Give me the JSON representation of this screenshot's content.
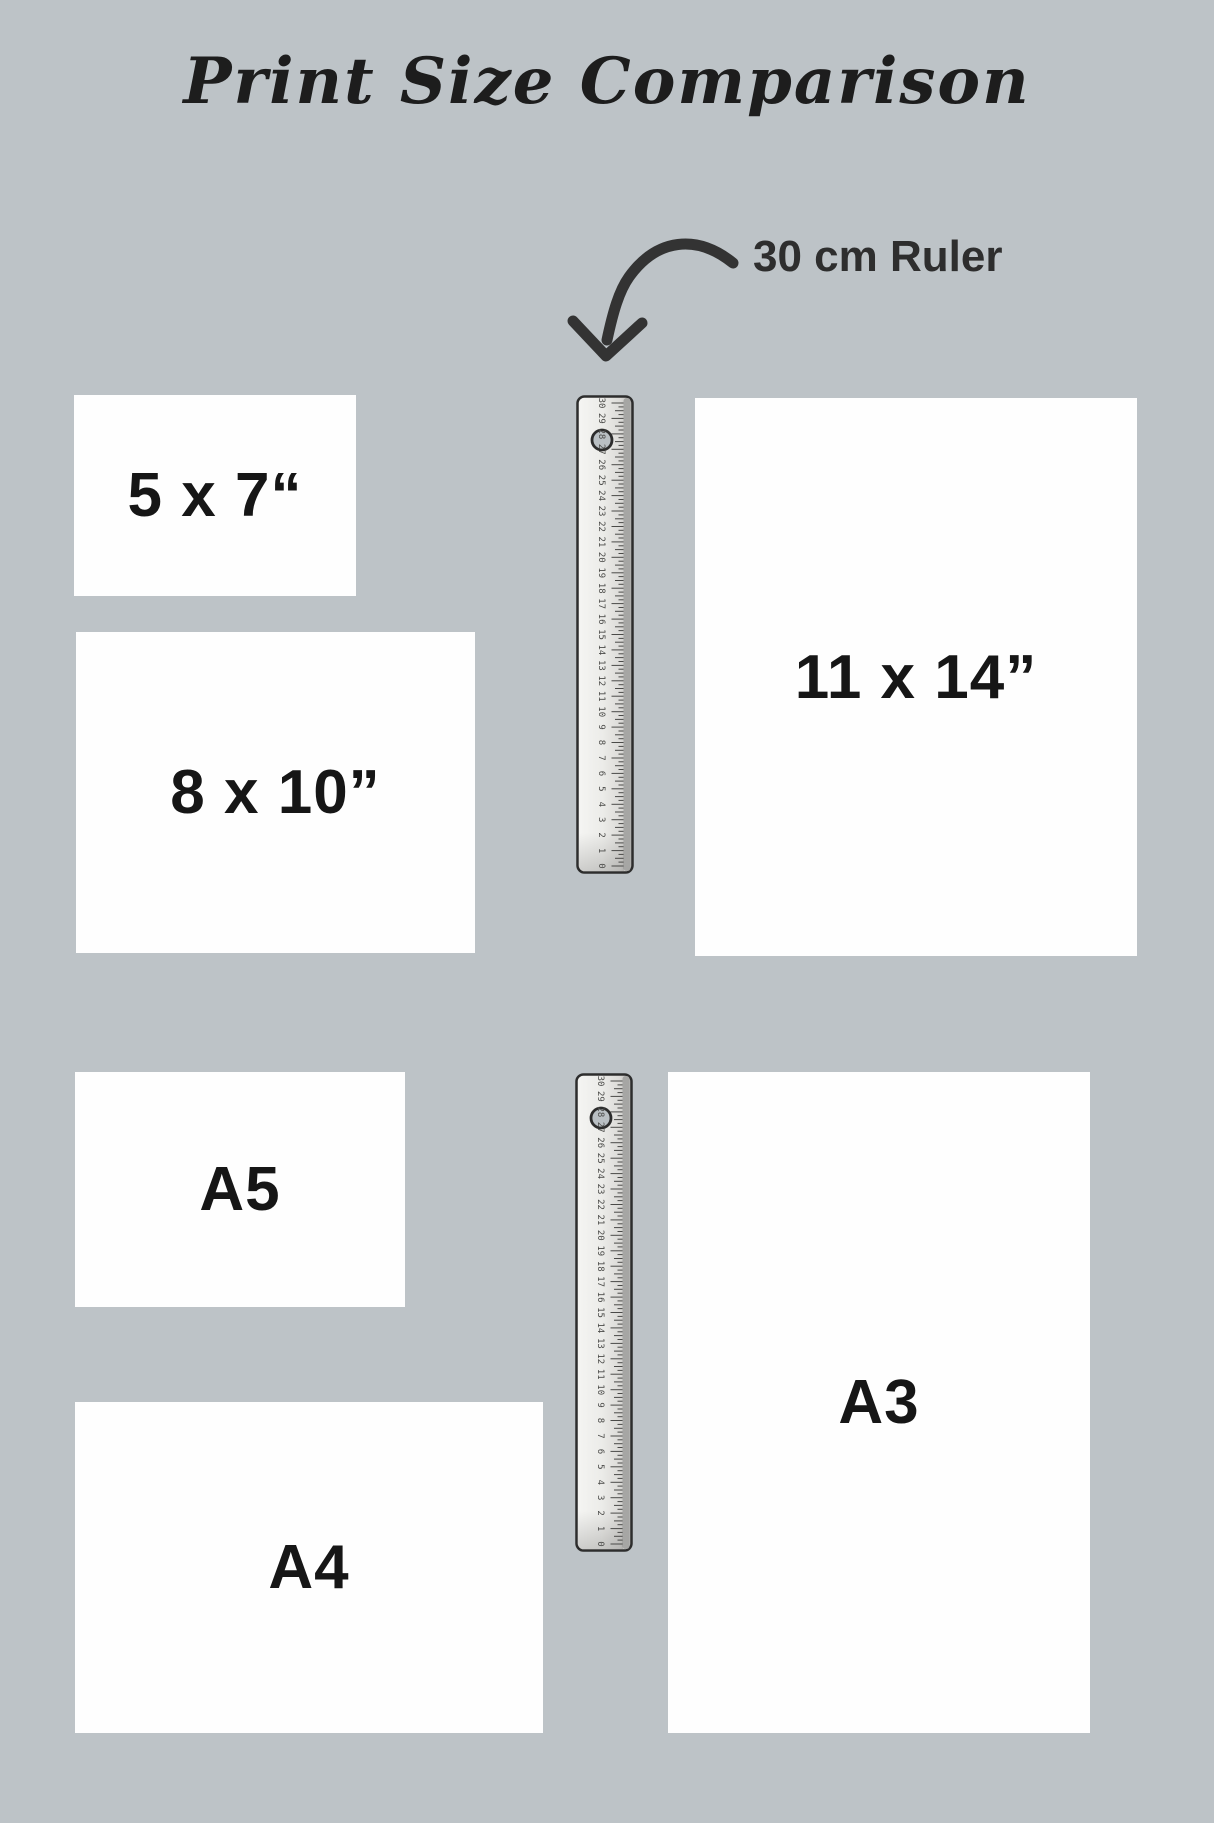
{
  "title": "Print Size Comparison",
  "annotation": {
    "ruler_label": "30 cm Ruler"
  },
  "prints": [
    {
      "id": "5x7",
      "label": "5 x 7“"
    },
    {
      "id": "8x10",
      "label": "8 x 10”"
    },
    {
      "id": "11x14",
      "label": "11 x 14”"
    },
    {
      "id": "a5",
      "label": "A5"
    },
    {
      "id": "a4",
      "label": "A4"
    },
    {
      "id": "a3",
      "label": "A3"
    }
  ],
  "ruler": {
    "unit": "cm",
    "min": 0,
    "max": 30,
    "label_numbers": [
      0,
      1,
      2,
      3,
      4,
      5,
      6,
      7,
      8,
      9,
      10,
      11,
      12,
      13,
      14,
      15,
      16,
      17,
      18,
      19,
      20,
      21,
      22,
      23,
      24,
      25,
      26,
      27,
      28,
      29,
      30
    ]
  },
  "colors": {
    "background": "#bdc3c7",
    "paper": "#fefefe",
    "ink": "#161616",
    "arrow": "#333333",
    "ruler_body": "#ebebe9",
    "ruler_border": "#2d2d2d"
  }
}
